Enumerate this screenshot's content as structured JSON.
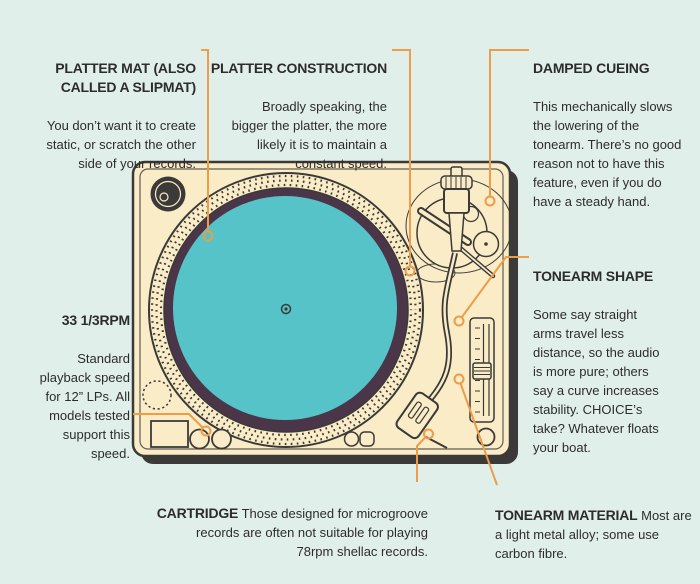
{
  "colors": {
    "bg": "#e1efeb",
    "ink": "#3b3a39",
    "cream": "#f9ecc6",
    "teal": "#55c3c7",
    "record": "#4b3548",
    "accent": "#ed9c49",
    "text": "#2d2c2b"
  },
  "annotations": {
    "platter_mat": {
      "title": "PLATTER MAT (ALSO\nCALLED A SLIPMAT)",
      "body": "You don’t want it to create\nstatic, or scratch the other\nside of your records."
    },
    "platter_construction": {
      "title": "PLATTER CONSTRUCTION",
      "body": "Broadly speaking, the\nbigger the platter, the more\nlikely it is to maintain a\nconstant speed."
    },
    "damped_cueing": {
      "title": "DAMPED CUEING",
      "body": "This mechanically slows\nthe lowering of the\ntonearm. There’s no good\nreason not to have this\nfeature, even if you do\nhave a steady hand."
    },
    "tonearm_shape": {
      "title": "TONEARM SHAPE",
      "body": "Some say straight\narms travel less\ndistance, so the audio\nis more pure; others\nsay a curve increases\nstability. CHOICE’s\ntake? Whatever floats\nyour boat."
    },
    "rpm_33": {
      "title": "33 1/3RPM",
      "body": "Standard\nplayback speed\nfor 12” LPs. All\nmodels tested\nsupport this\nspeed."
    },
    "cartridge": {
      "lead": "CARTRIDGE",
      "body": " Those designed for microgroove\nrecords are often not suitable for playing\n78rpm shellac records."
    },
    "tonearm_material": {
      "lead": "TONEARM MATERIAL",
      "body": " Most are\na light metal alloy; some use\ncarbon fibre."
    }
  }
}
